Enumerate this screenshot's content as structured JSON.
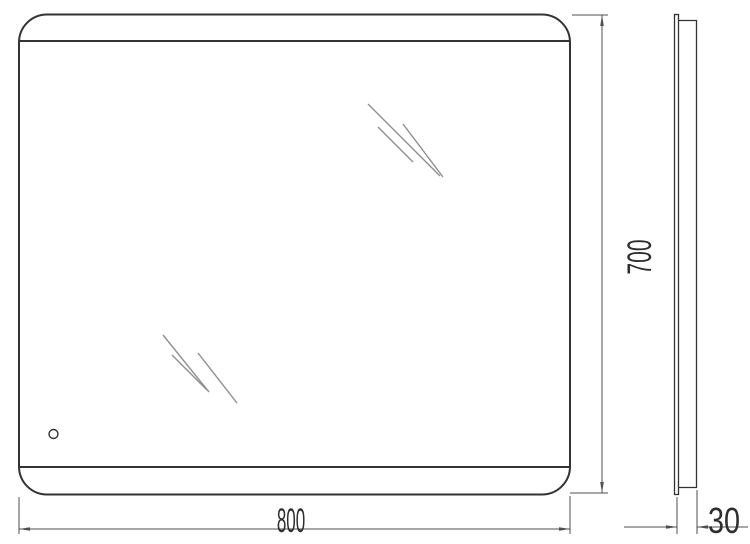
{
  "dimensions": {
    "width_label": "800",
    "height_label": "700",
    "depth_label": "30"
  },
  "colors": {
    "background": "#ffffff",
    "outline": "#333333",
    "dimension": "#4f4f4f",
    "shine": "#8f8f8f",
    "text": "#2e2e2e"
  }
}
